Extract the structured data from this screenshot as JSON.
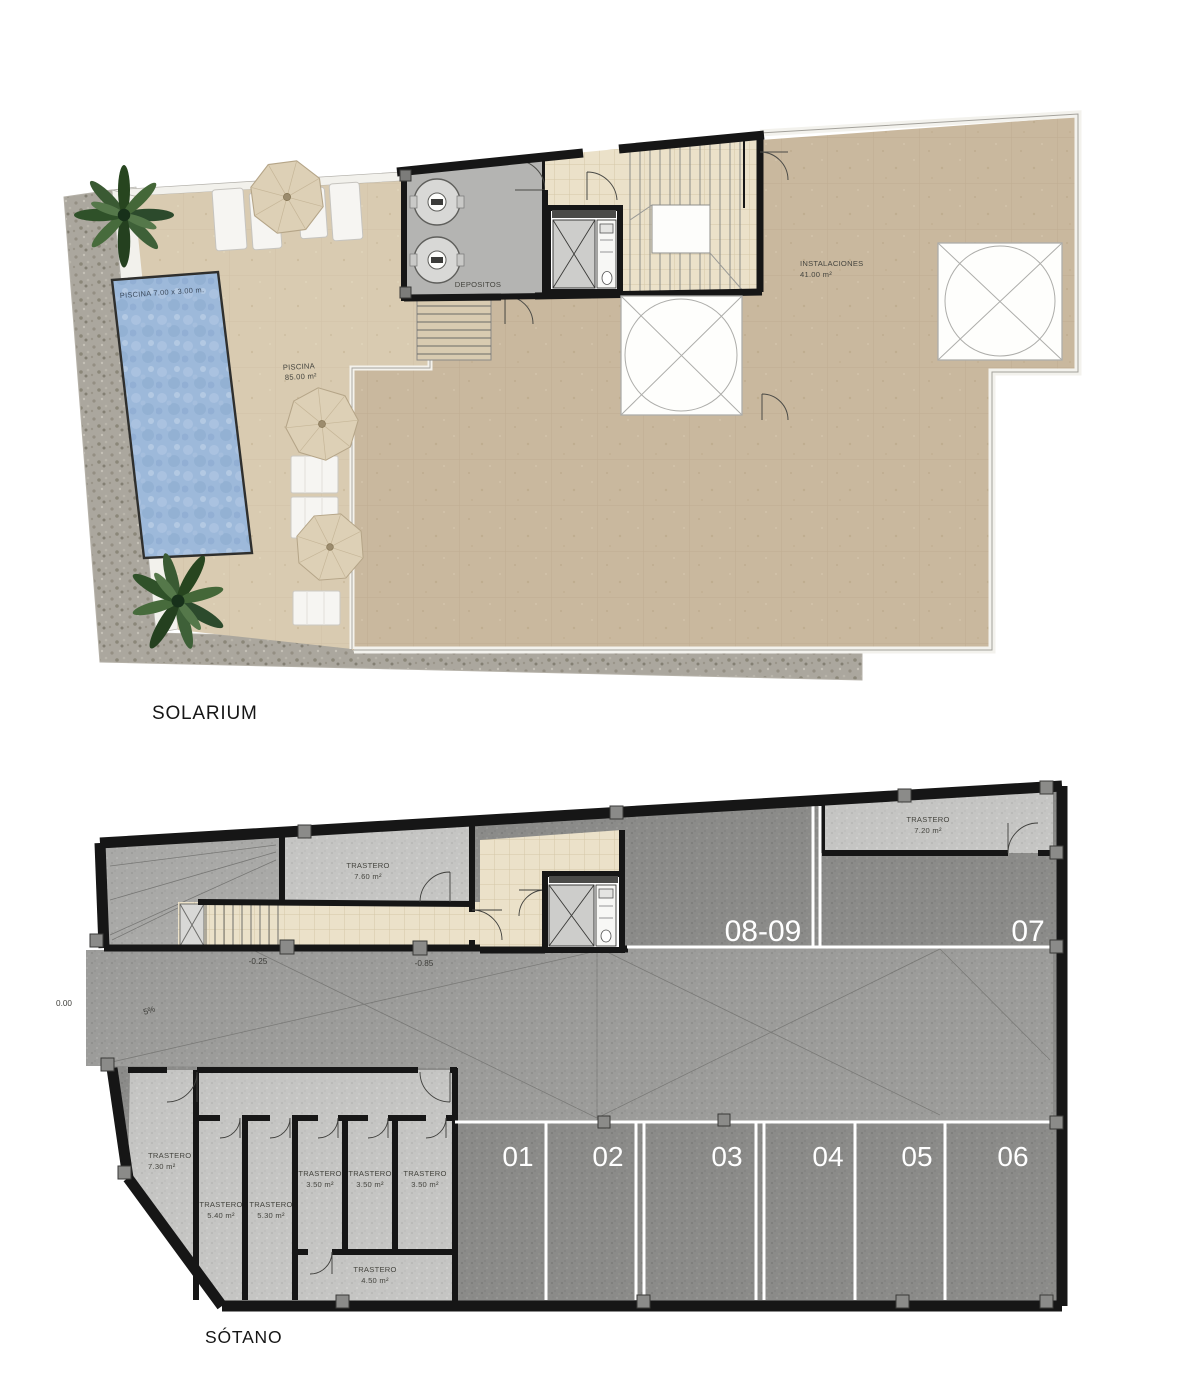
{
  "plans": {
    "solarium": {
      "title": "SOLARIUM",
      "pool_dimensions": "PISCINA 7.00 x 3.00 m.",
      "pool_area_label": "PISCINA",
      "pool_area_value": "85.00 m²",
      "depositos_label": "DEPOSITOS",
      "instalaciones_label": "INSTALACIONES",
      "instalaciones_area": "41.00 m²"
    },
    "sotano": {
      "title": "SÓTANO",
      "levels": {
        "street": "0.00",
        "ramp_slope": "5%",
        "aisle_upper": "-0.25",
        "aisle_lower": "-0.85"
      },
      "parking_spots": {
        "top": [
          "08-09",
          "07"
        ],
        "bottom": [
          "01",
          "02",
          "03",
          "04",
          "05",
          "06"
        ]
      },
      "trasteros": {
        "t760": {
          "label": "TRASTERO",
          "area": "7.60 m²"
        },
        "t720": {
          "label": "TRASTERO",
          "area": "7.20 m²"
        },
        "t730": {
          "label": "TRASTERO",
          "area": "7.30 m²"
        },
        "t540": {
          "label": "TRASTERO",
          "area": "5.40 m²"
        },
        "t530": {
          "label": "TRASTERO",
          "area": "5.30 m²"
        },
        "t350a": {
          "label": "TRASTERO",
          "area": "3.50 m²"
        },
        "t350b": {
          "label": "TRASTERO",
          "area": "3.50 m²"
        },
        "t350c": {
          "label": "TRASTERO",
          "area": "3.50 m²"
        },
        "t450": {
          "label": "TRASTERO",
          "area": "4.50 m²"
        }
      }
    }
  },
  "colors": {
    "terrace_tan": "#c9b89e",
    "terrace_light": "#d9cbb1",
    "pool_blue": "#9db9da",
    "gravel": "#aba79e",
    "tile_beige": "#ebe1c9",
    "parking_dark": "#8b8b89",
    "parking_aisle": "#9c9c9a",
    "storage_light": "#c5c5c3",
    "wall_black": "#161616",
    "parking_line_white": "#ffffff"
  }
}
